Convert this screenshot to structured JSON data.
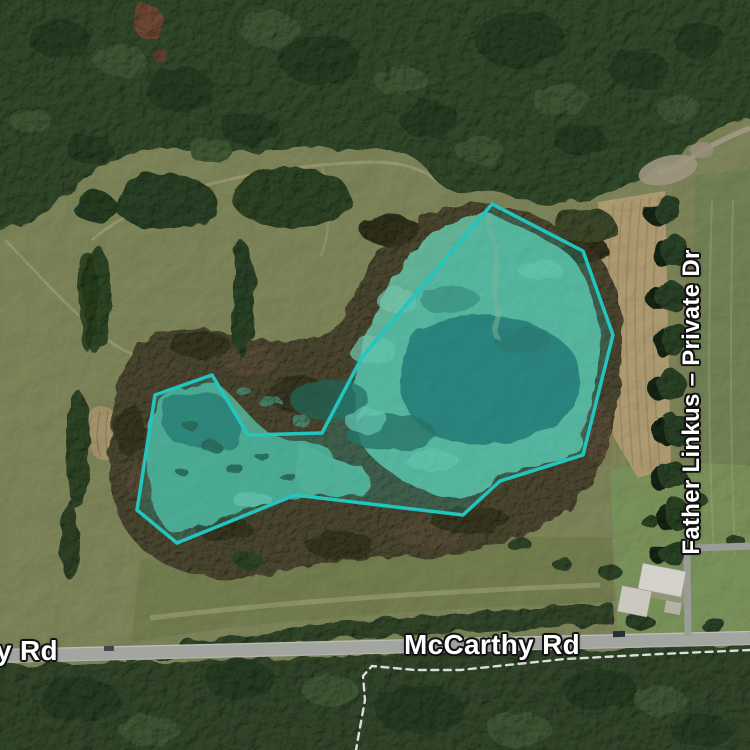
{
  "parcel": {
    "outline_points": "492,204 583,251 613,335 583,455 500,481 463,515 295,495 177,543 137,510 155,395 212,375 248,435 322,433 362,357",
    "stroke_color": "#28ddd5",
    "fill_color": "rgba(40,221,213,0.20)"
  },
  "labels": {
    "road_main": "McCarthy Rd",
    "road_left_partial": "y Rd",
    "private_drive": "Father Linkus – Private Dr"
  },
  "label_style": {
    "text_color": "#ffffff",
    "halo_color": "#111111"
  }
}
